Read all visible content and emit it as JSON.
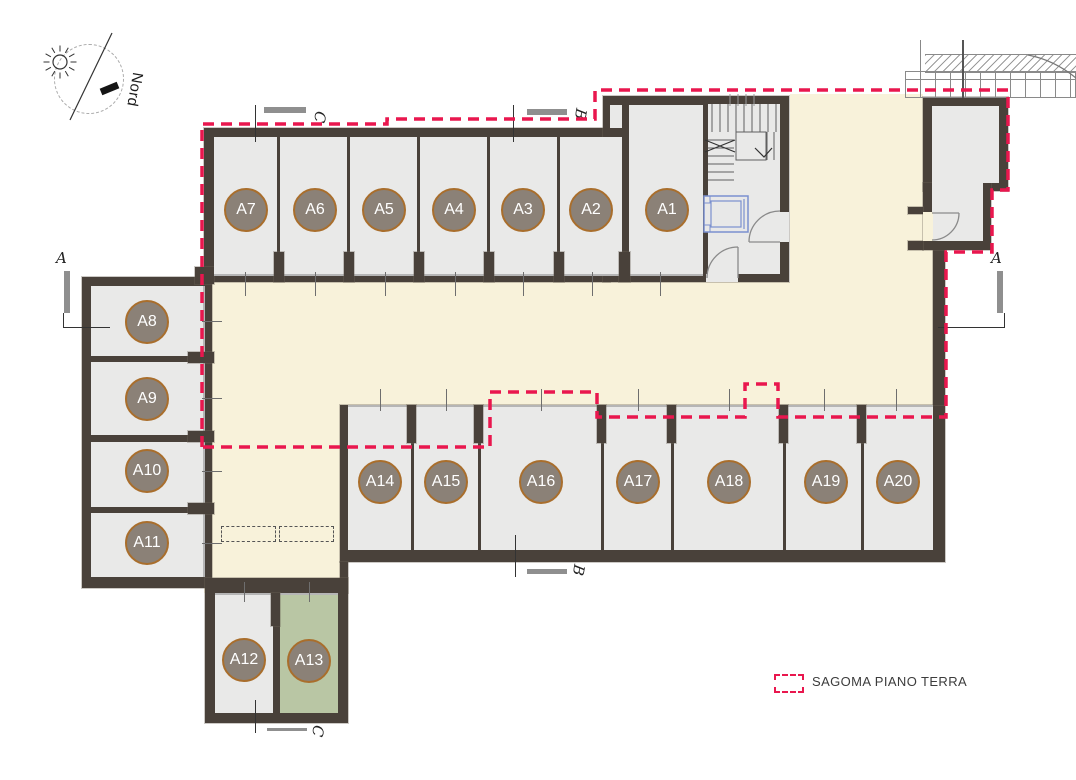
{
  "north_indicator": {
    "label": "Nord"
  },
  "legend": {
    "label": "SAGOMA PIANO TERRA"
  },
  "sections": {
    "top_c": "C",
    "top_b": "B",
    "left_a": "A",
    "right_a": "A",
    "bottom_b": "B",
    "bottom_c": "C"
  },
  "units": [
    {
      "label": "A1",
      "x": 667,
      "y": 210
    },
    {
      "label": "A2",
      "x": 591,
      "y": 210
    },
    {
      "label": "A3",
      "x": 523,
      "y": 210
    },
    {
      "label": "A4",
      "x": 454,
      "y": 210
    },
    {
      "label": "A5",
      "x": 384,
      "y": 210
    },
    {
      "label": "A6",
      "x": 315,
      "y": 210
    },
    {
      "label": "A7",
      "x": 246,
      "y": 210
    },
    {
      "label": "A8",
      "x": 147,
      "y": 322
    },
    {
      "label": "A9",
      "x": 147,
      "y": 399
    },
    {
      "label": "A10",
      "x": 147,
      "y": 471
    },
    {
      "label": "A11",
      "x": 147,
      "y": 543
    },
    {
      "label": "A12",
      "x": 244,
      "y": 660
    },
    {
      "label": "A13",
      "x": 309,
      "y": 661,
      "highlight": true
    },
    {
      "label": "A14",
      "x": 380,
      "y": 482
    },
    {
      "label": "A15",
      "x": 446,
      "y": 482
    },
    {
      "label": "A16",
      "x": 541,
      "y": 482
    },
    {
      "label": "A17",
      "x": 638,
      "y": 482
    },
    {
      "label": "A18",
      "x": 729,
      "y": 482
    },
    {
      "label": "A19",
      "x": 826,
      "y": 482
    },
    {
      "label": "A20",
      "x": 898,
      "y": 482
    }
  ],
  "colors": {
    "wall": "#49413a",
    "unit_fill": "#e9e9e8",
    "corridor_fill": "#f8f2da",
    "unit_a13_fill": "#b9c6a4",
    "badge_fill": "#8b8177",
    "badge_border": "#a96e2c",
    "outline_red": "#e9174e",
    "bar_gray": "#8f8f8f",
    "open_edge": "#b5b5b5",
    "elevator_blue": "#7b90cf"
  }
}
